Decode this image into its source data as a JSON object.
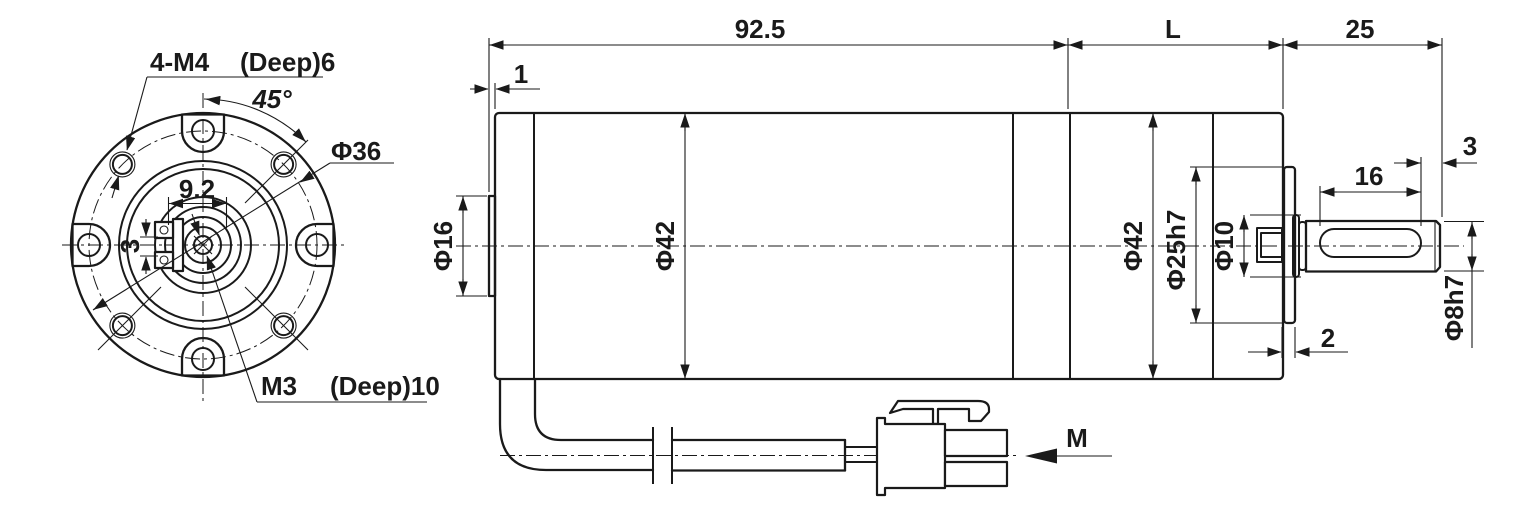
{
  "front_view": {
    "screw_callout": "4-M4",
    "screw_depth": "(Deep)6",
    "angle_label": "45°",
    "bolt_circle": "Φ36",
    "key_width": "9.2",
    "key_height": "3",
    "center_tap": "M3",
    "center_tap_depth": "(Deep)10"
  },
  "side_view": {
    "motor_length": "92.5",
    "boss_step": "1",
    "gearhead_length": "L",
    "shaft_total": "25",
    "shaft_tip": "3",
    "key_length": "16",
    "rear_boss_dia": "Φ16",
    "motor_dia": "Φ42",
    "gearhead_dia": "Φ42",
    "pilot_dia": "Φ25h7",
    "hub_dia": "Φ10",
    "pilot_height": "2",
    "shaft_dia": "Φ8h7",
    "wire_label": "M"
  }
}
